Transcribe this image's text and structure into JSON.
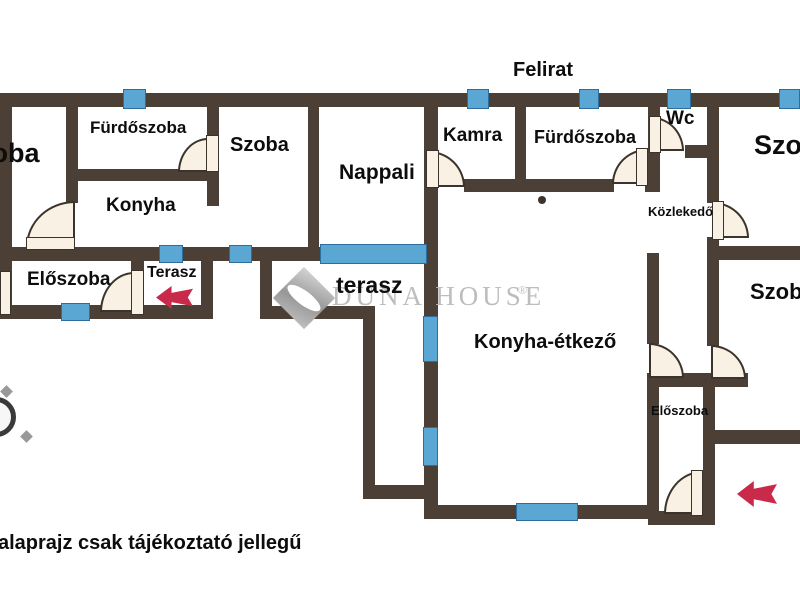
{
  "texts": {
    "felirat": "Felirat",
    "disclaimer": "alaprajz csak tájékoztató jellegű"
  },
  "watermark": {
    "brand": "DUNA HOUSE",
    "reg": "®"
  },
  "rooms": {
    "szoba1": "Szoba",
    "furdoszoba1": "Fürdőszoba",
    "szoba2": "Szoba",
    "konyha": "Konyha",
    "nappali": "Nappali",
    "kamra": "Kamra",
    "furdoszoba2": "Fürdőszoba",
    "wc": "Wc",
    "szoba3": "Szoba",
    "kozlekedo": "Közlekedő",
    "szoba4": "Szoba",
    "eloszoba1": "Előszoba",
    "terasz_small": "Terasz",
    "terasz_big": "terasz",
    "konyha_etkezo": "Konyha-étkező",
    "eloszoba2": "Előszoba"
  },
  "colors": {
    "wall": "#4c3f35",
    "window": "#5aa7d3",
    "door": "#f8f1e4",
    "arrow_red": "#c92a4a",
    "watermark_gray": "#bdbdbd"
  }
}
